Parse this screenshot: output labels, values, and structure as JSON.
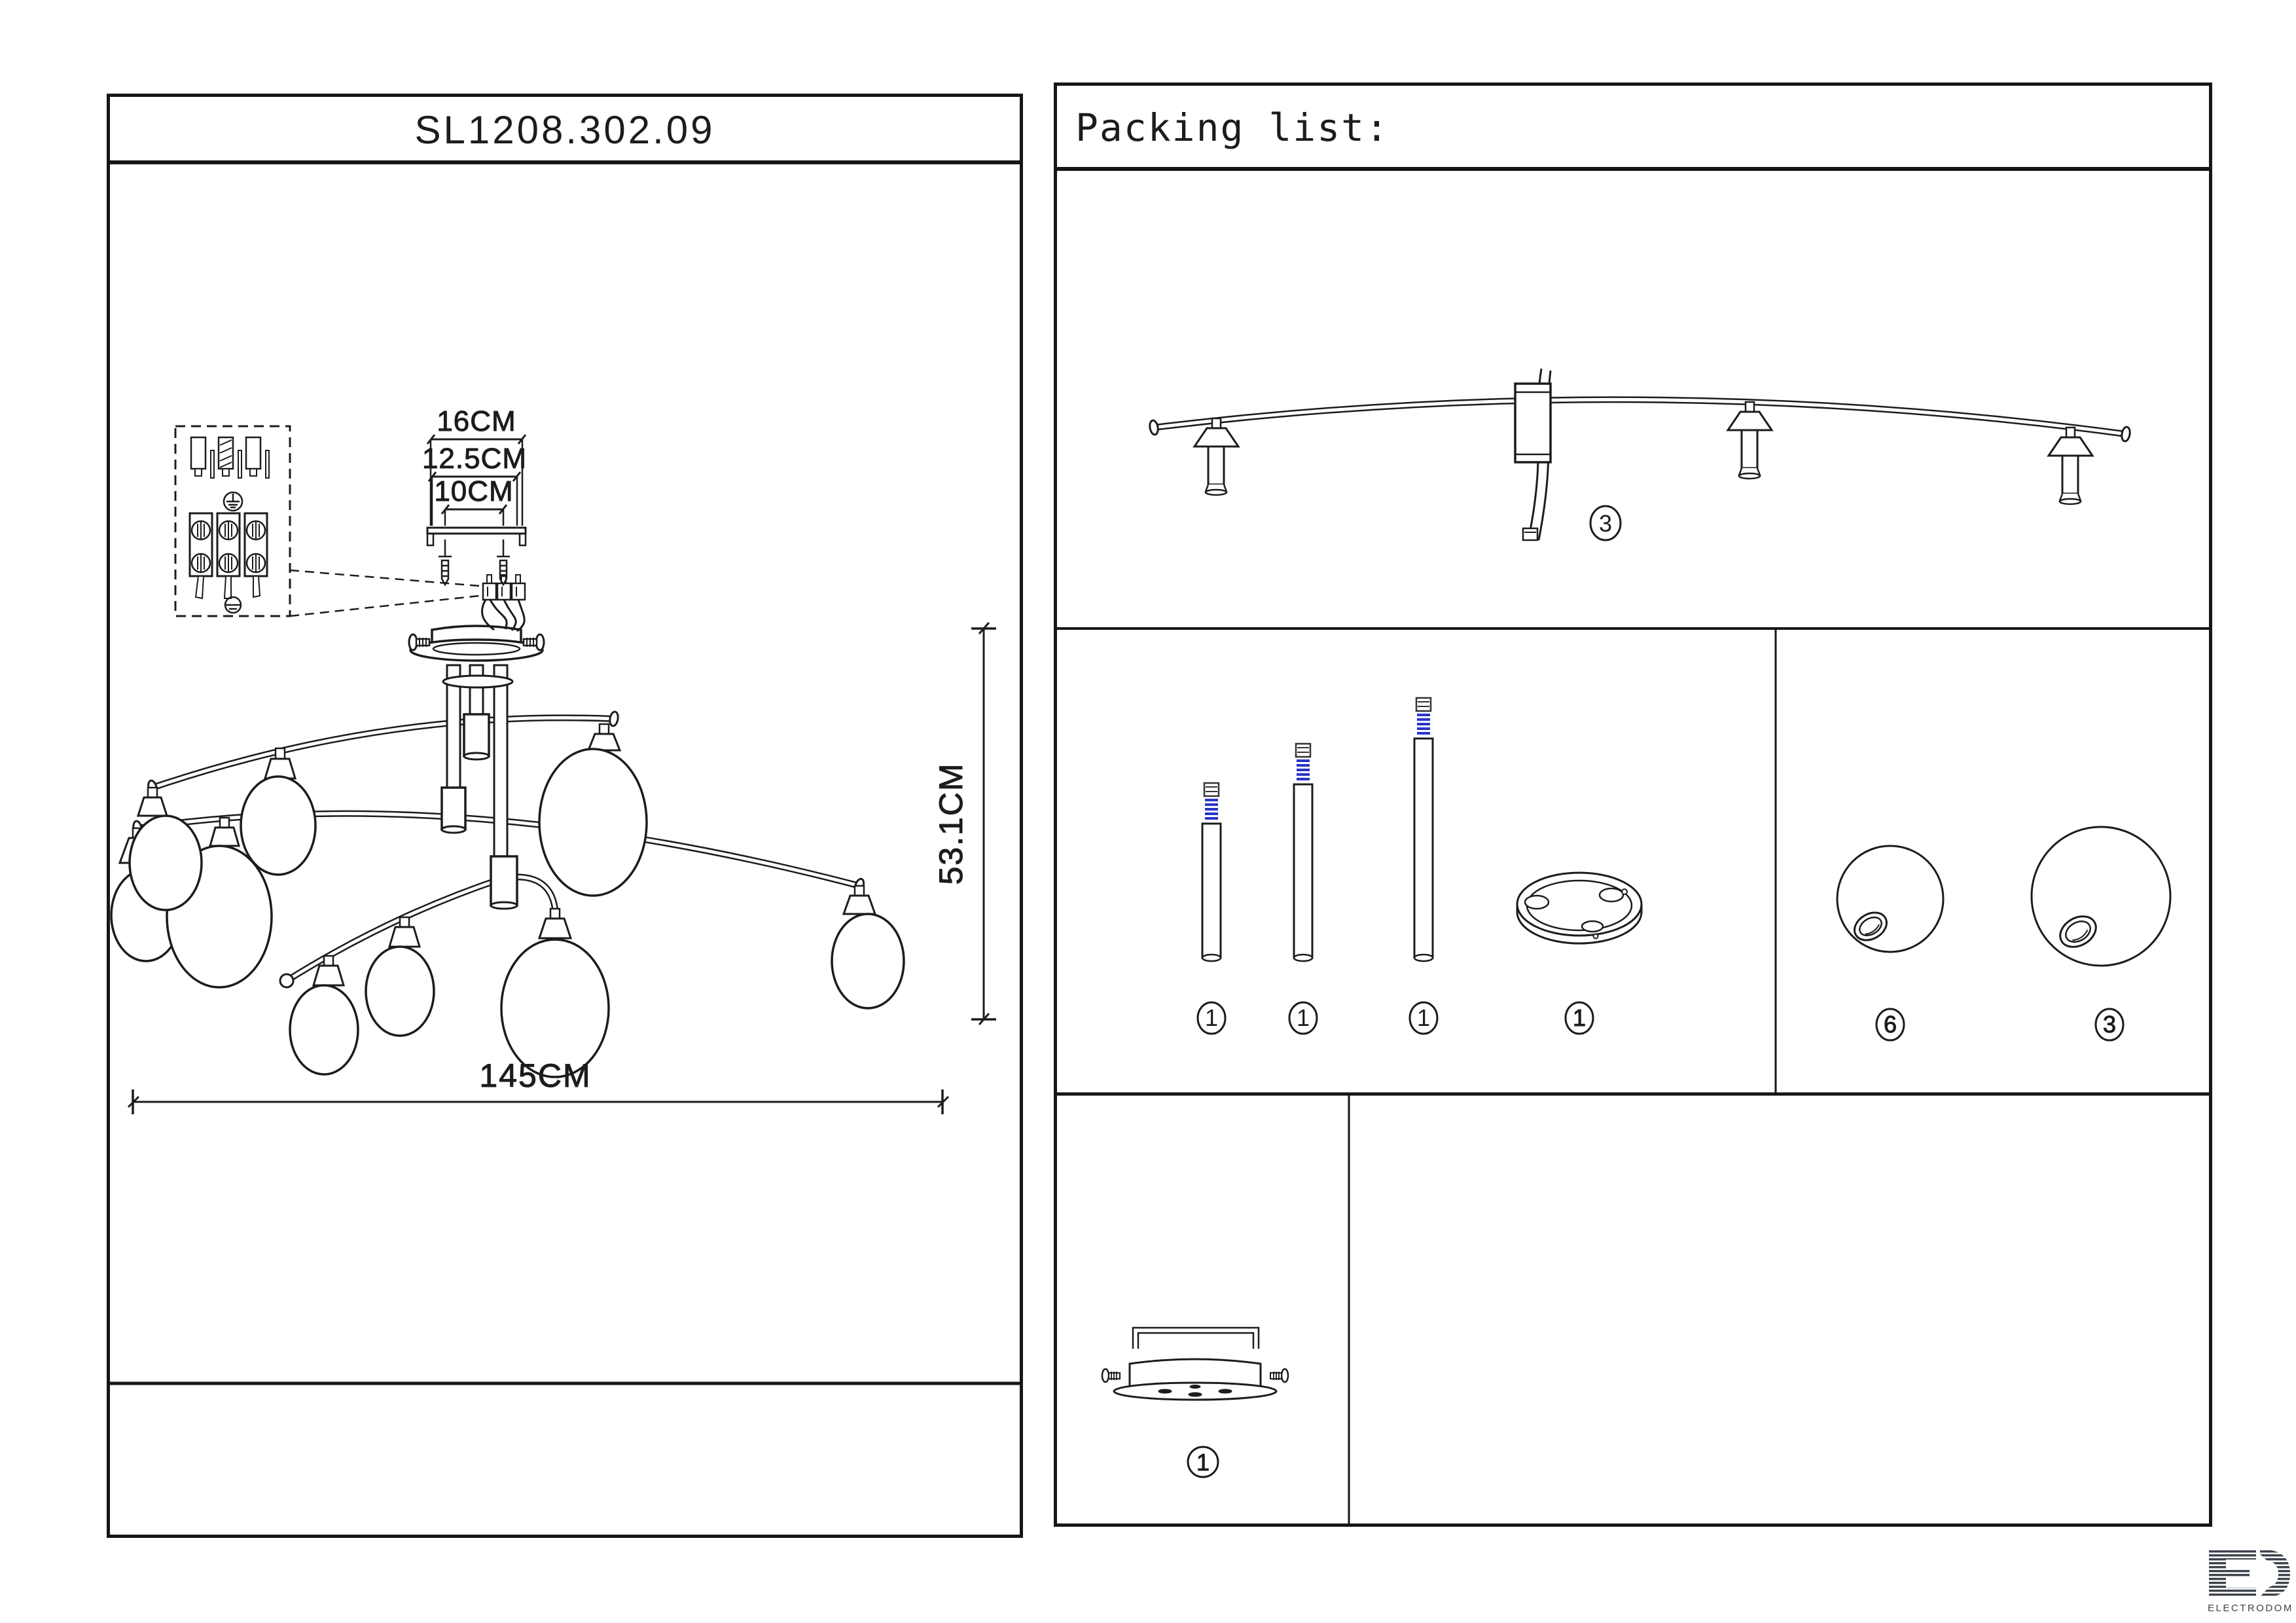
{
  "page": {
    "model": "SL1208.302.09"
  },
  "dimensions": {
    "d16": "16CM",
    "d125": "12.5CM",
    "d10": "10CM",
    "height": "53.1CM",
    "span": "145CM"
  },
  "packing_list": {
    "title": "Packing list:",
    "items": [
      {
        "name": "curved-arm-with-3-sockets-and-wires",
        "qty": "3"
      },
      {
        "name": "down-rod-short-blue-coupler",
        "qty": "1"
      },
      {
        "name": "down-rod-medium-blue-coupler",
        "qty": "1"
      },
      {
        "name": "down-rod-long-blue-coupler",
        "qty": "1"
      },
      {
        "name": "mounting-ring",
        "qty": "1"
      },
      {
        "name": "glass-globe-small",
        "qty": "6"
      },
      {
        "name": "glass-globe-large",
        "qty": "3"
      },
      {
        "name": "ceiling-plate-with-bracket-screws",
        "qty": "1"
      }
    ]
  },
  "logo": {
    "text": "ELECTRODOM"
  },
  "colors": {
    "line": "#1c1c1c",
    "coupler_blue": "#2a35c9",
    "logo": "#3d434d"
  }
}
